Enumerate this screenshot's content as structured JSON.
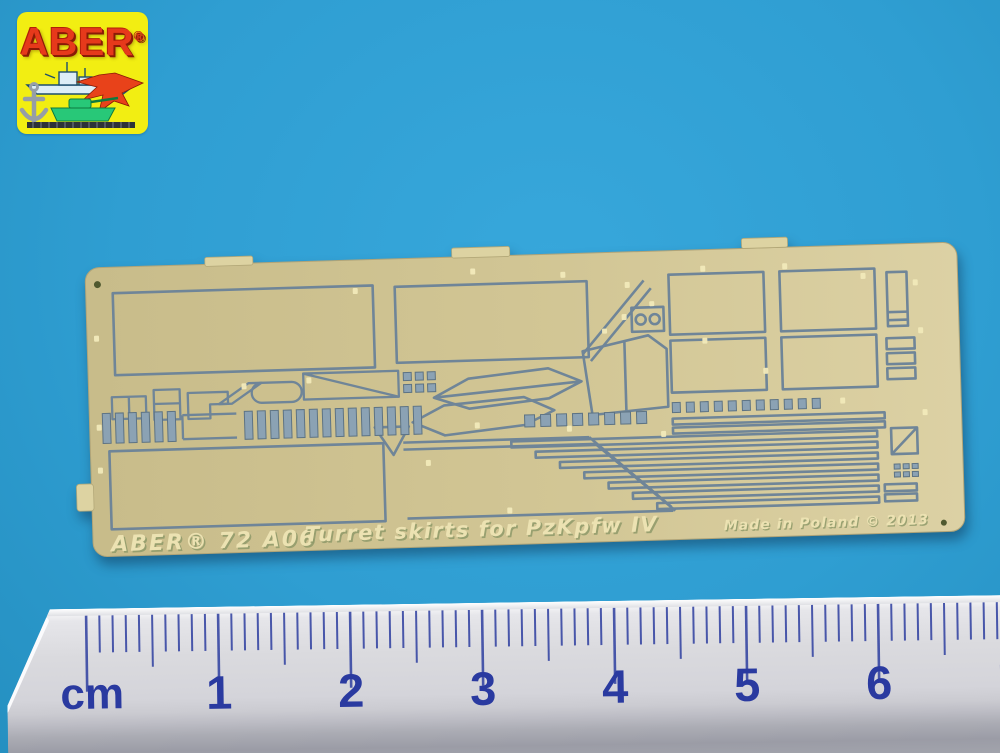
{
  "photo": {
    "background_color": "#2f9ed2"
  },
  "logo": {
    "brand": "ABER",
    "registered_mark": "®",
    "background_color": "#f2ee12",
    "wordmark_color": "#e6391b",
    "icons": [
      "anchor-icon",
      "battleship-icon",
      "fighter-jet-icon",
      "tank-icon"
    ]
  },
  "fret": {
    "marking_left": "ABER® 72 A06",
    "marking_center": "Turret skirts for PzKpfw IV",
    "marking_right": "Made in Poland © 2013",
    "brass_color": "#cfc494",
    "etch_color": "#6f8598"
  },
  "ruler": {
    "unit_label": "cm",
    "numbers": [
      1,
      2,
      3,
      4,
      5,
      6,
      7
    ],
    "tick_color": "#3848a4",
    "number_color": "#2a3aa0",
    "origin_x": 88,
    "cm_spacing": 132,
    "minor_spacing": 13.2,
    "minor_tick_count": 72
  }
}
